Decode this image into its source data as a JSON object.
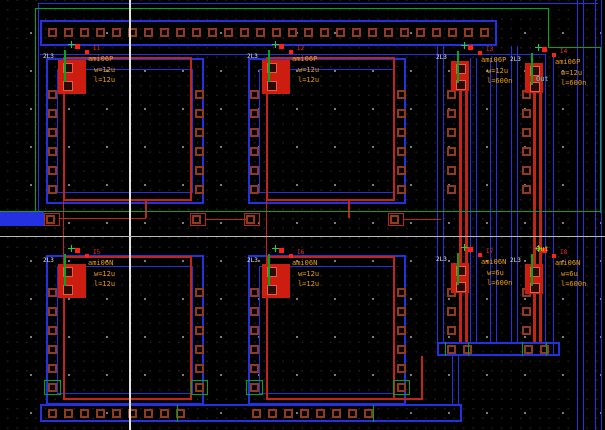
{
  "colors": {
    "background": "#000000",
    "grid_dot": "#9a9a9a",
    "grid_dot_minor": "#202020",
    "axis": "#e2e2e2",
    "metal_blue": "#2331e0",
    "well_green": "#00a520",
    "poly_red": "#c22418",
    "device_red": "#cc1d10",
    "contact_brown": "#8f3c1e",
    "label_orange": "#efa00a",
    "label_red": "#ff2a2a",
    "label_cyan": "#30e8e8",
    "label_yellow": "#d8d800",
    "micro_white": "#e8e8e8"
  },
  "devices": [
    {
      "instance": "I1",
      "micro": "2L3",
      "cell": "ami06P",
      "width_label": "w=12u",
      "length_label": "l=12u"
    },
    {
      "instance": "I2",
      "micro": "2L3",
      "cell": "ami06P",
      "width_label": "w=12u",
      "length_label": "l=12u"
    },
    {
      "instance": "I3",
      "micro": "2L3",
      "cell": "ami06P",
      "width_label": "w=12u",
      "length_label": "l=600n"
    },
    {
      "instance": "I4",
      "micro": "2L3",
      "cell": "ami06P",
      "width_label": "w=12u",
      "length_label": "l=600n"
    },
    {
      "instance": "I5",
      "micro": "2L3",
      "cell": "ami06N",
      "width_label": "w=12u",
      "length_label": "l=12u"
    },
    {
      "instance": "I6",
      "micro": "2L3",
      "cell": "ami06N",
      "width_label": "w=12u",
      "length_label": "l=12u"
    },
    {
      "instance": "I7",
      "micro": "2L3",
      "cell": "ami06N",
      "width_label": "w=6u",
      "length_label": "l=600n"
    },
    {
      "instance": "I8",
      "micro": "2L3",
      "cell": "ami06N",
      "width_label": "w=6u",
      "length_label": "l=600n"
    }
  ],
  "pins": [
    {
      "label": "Out"
    },
    {
      "label": "Out"
    }
  ]
}
